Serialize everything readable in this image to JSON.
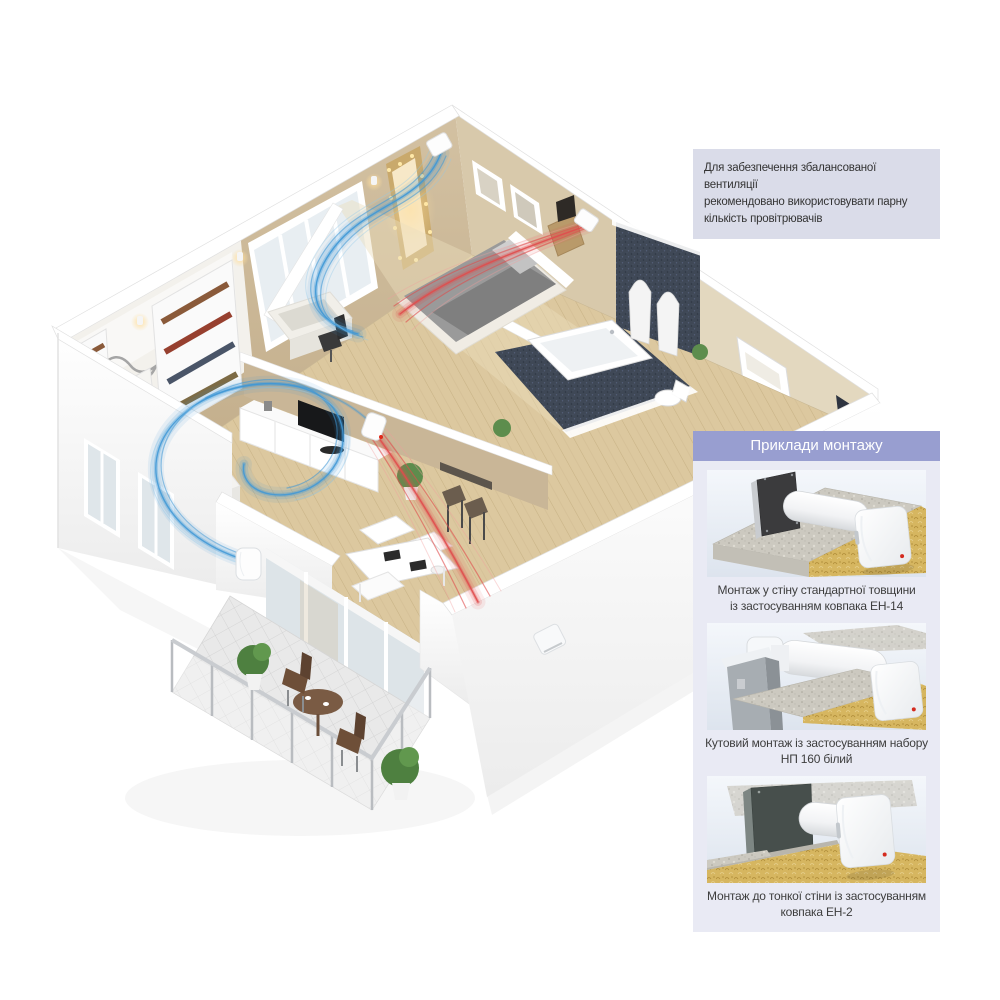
{
  "info_box": {
    "text": "Для забезпечення збалансованої вентиляції\nрекомендовано використовувати парну\nкількість провітрювачів"
  },
  "panel": {
    "header": "Приклади монтажу",
    "items": [
      {
        "caption": "Монтаж у стіну стандартної товщини\nіз застосуванням ковпака ЕН-14"
      },
      {
        "caption": "Кутовий монтаж із застосуванням набору\nНП 160 білий"
      },
      {
        "caption": "Монтаж до тонкої стіни із застосуванням\nковпака ЕН-2"
      }
    ]
  },
  "colors": {
    "accent_purple": "#989ed0",
    "panel_bg": "#e9eaf4",
    "info_bg": "#dadce9",
    "supply_air_blue": "#3f98d6",
    "exhaust_air_red": "#e04c4c",
    "wood_floor": "#dcc89f",
    "bathroom_navy": "#3f4856"
  },
  "icons": {
    "ventilator_unit": "white-vent-cap",
    "led_indicator": "red-dot"
  }
}
